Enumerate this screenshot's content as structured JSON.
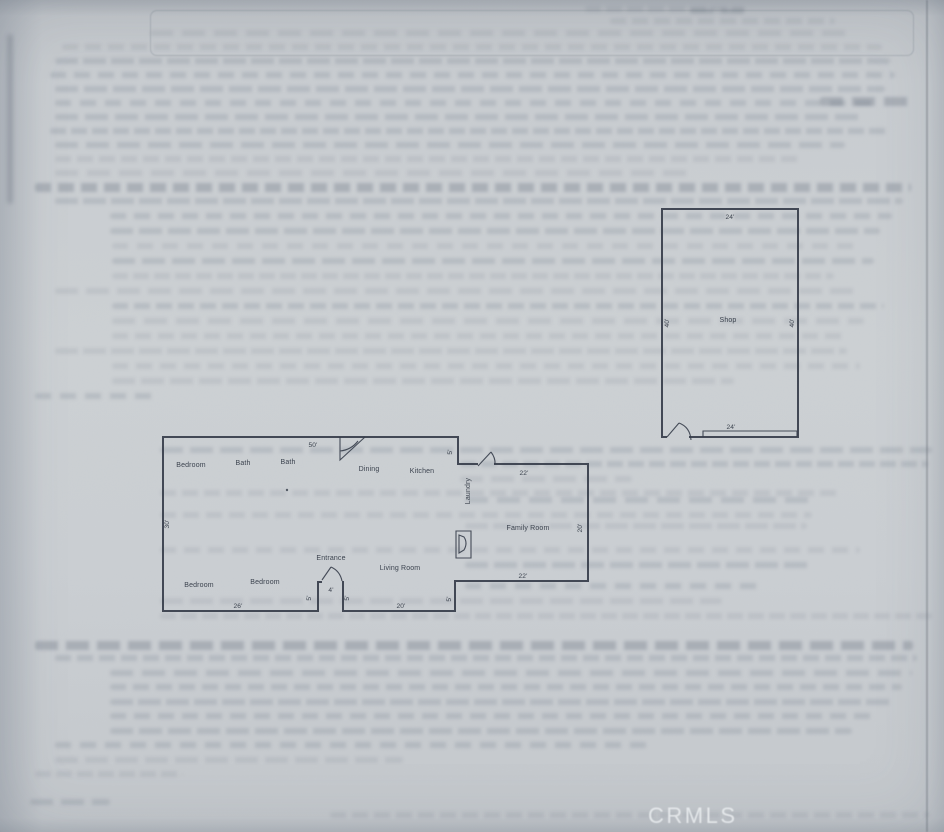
{
  "watermark": "CRMLS",
  "floorplan": {
    "house": {
      "rooms": [
        {
          "id": "bedroom-1",
          "label": "Bedroom"
        },
        {
          "id": "bath-1",
          "label": "Bath"
        },
        {
          "id": "bath-2",
          "label": "Bath"
        },
        {
          "id": "dining",
          "label": "Dining"
        },
        {
          "id": "kitchen",
          "label": "Kitchen"
        },
        {
          "id": "laundry",
          "label": "Laundry"
        },
        {
          "id": "family-room",
          "label": "Family Room"
        },
        {
          "id": "entrance",
          "label": "Entrance"
        },
        {
          "id": "living-room",
          "label": "Living Room"
        },
        {
          "id": "bedroom-2",
          "label": "Bedroom"
        },
        {
          "id": "bedroom-3",
          "label": "Bedroom"
        }
      ],
      "dims": [
        {
          "id": "top-width",
          "label": "50'"
        },
        {
          "id": "left-depth",
          "label": "30'"
        },
        {
          "id": "bottom-left-width",
          "label": "26'"
        },
        {
          "id": "entrance-left",
          "label": "5'"
        },
        {
          "id": "entrance-width",
          "label": "4'"
        },
        {
          "id": "entrance-right",
          "label": "5'"
        },
        {
          "id": "bottom-mid-width",
          "label": "20'"
        },
        {
          "id": "family-bottom-jog",
          "label": "5'"
        },
        {
          "id": "family-bottom",
          "label": "22'"
        },
        {
          "id": "family-right",
          "label": "20'"
        },
        {
          "id": "family-top",
          "label": "22'"
        },
        {
          "id": "kitchen-jog",
          "label": "5'"
        }
      ]
    },
    "shop": {
      "label": "Shop",
      "dims": [
        {
          "id": "top-width",
          "label": "24'"
        },
        {
          "id": "left-depth",
          "label": "40'"
        },
        {
          "id": "right-depth",
          "label": "40'"
        },
        {
          "id": "bottom-width",
          "label": "24'"
        }
      ]
    }
  }
}
